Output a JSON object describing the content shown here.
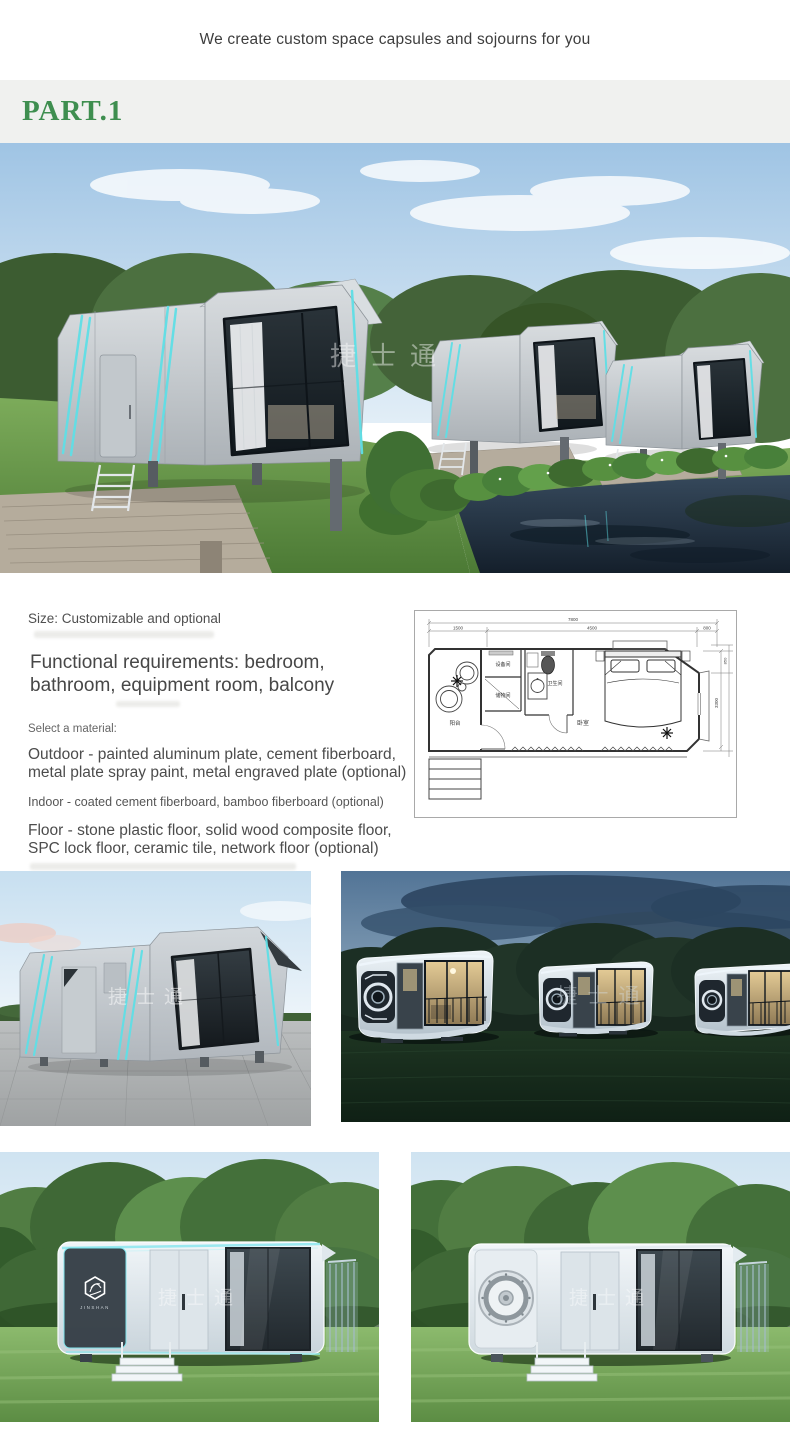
{
  "banner": {
    "title": "We create custom space capsules and sojourns for you"
  },
  "section": {
    "label": "PART.1",
    "accent_color": "#3e8e4f"
  },
  "intro": {
    "size_line": "Size: Customizable and optional",
    "functional_line1": "Functional requirements: bedroom,",
    "functional_line2": "bathroom, equipment room, balcony",
    "select_label": "Select a material:",
    "outdoor_line1": "Outdoor - painted aluminum plate, cement fiberboard,",
    "outdoor_line2": "metal plate spray paint, metal engraved plate (optional)",
    "indoor_line": "Indoor - coated cement fiberboard, bamboo fiberboard (optional)",
    "floor_line1": "Floor - stone plastic floor, solid wood composite floor,",
    "floor_line2": "SPC lock floor, ceramic tile, network floor (optional)"
  },
  "floor_plan": {
    "room_balcony": "阳台",
    "room_equipment": "设备间",
    "room_storage": "储物间",
    "room_bathroom": "卫生间",
    "room_bedroom": "卧室",
    "dim_total": "7800",
    "dim_seg_left": "1500",
    "dim_seg_mid": "4500",
    "dim_seg_right": "800",
    "dim_side": "3300",
    "dim_side_small": "850"
  },
  "watermark": {
    "text": "捷士通"
  },
  "brand": {
    "logo_caption": "JINSHAN"
  },
  "palette": {
    "capsule_cyan": "#5fdfe6",
    "band_bg": "#f0f1ef",
    "text_dark": "#4c4c4c"
  }
}
